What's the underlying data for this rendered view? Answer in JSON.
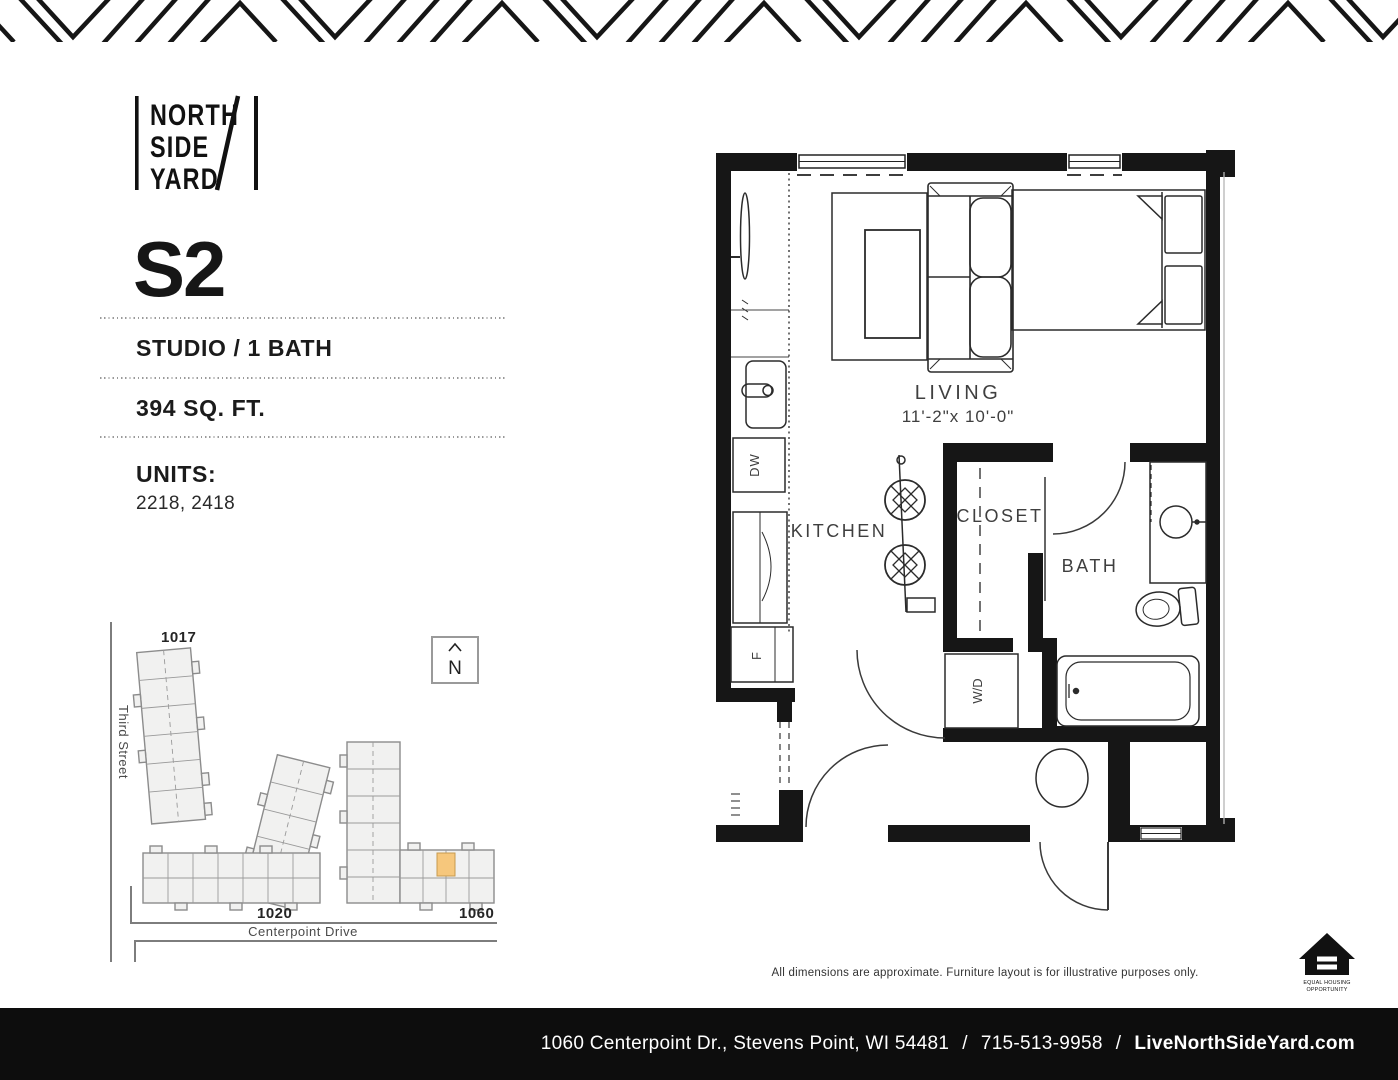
{
  "logo": {
    "line1": "NORTH",
    "line2": "SIDE",
    "line3": "YARD"
  },
  "plan": {
    "name": "S2",
    "type": "STUDIO / 1 BATH",
    "area": "394 SQ. FT.",
    "units_label": "UNITS:",
    "units": "2218, 2418"
  },
  "site_map": {
    "north_label": "N",
    "streets": {
      "vertical": "Third Street",
      "horizontal": "Centerpoint Drive"
    },
    "buildings": [
      {
        "label": "1017"
      },
      {
        "label": "1020"
      },
      {
        "label": "1060"
      }
    ],
    "highlight_color": "#F6C77C"
  },
  "floor_plan": {
    "rooms": {
      "living": {
        "label": "LIVING",
        "dimensions": "11'-2\"x 10'-0\""
      },
      "kitchen": {
        "label": "KITCHEN"
      },
      "closet": {
        "label": "CLOSET"
      },
      "bath": {
        "label": "BATH"
      }
    },
    "appliances": {
      "dishwasher": "DW",
      "fridge": "F",
      "washer_dryer": "W/D"
    }
  },
  "disclaimer": "All dimensions are approximate. Furniture layout is for illustrative purposes only.",
  "eho": {
    "line1": "EQUAL HOUSING",
    "line2": "OPPORTUNITY"
  },
  "footer": {
    "address": "1060 Centerpoint Dr., Stevens Point, WI 54481",
    "separator": "/",
    "phone": "715-513-9958",
    "website": "LiveNorthSideYard.com"
  },
  "colors": {
    "ink": "#161616",
    "highlight": "#F6C77C"
  }
}
